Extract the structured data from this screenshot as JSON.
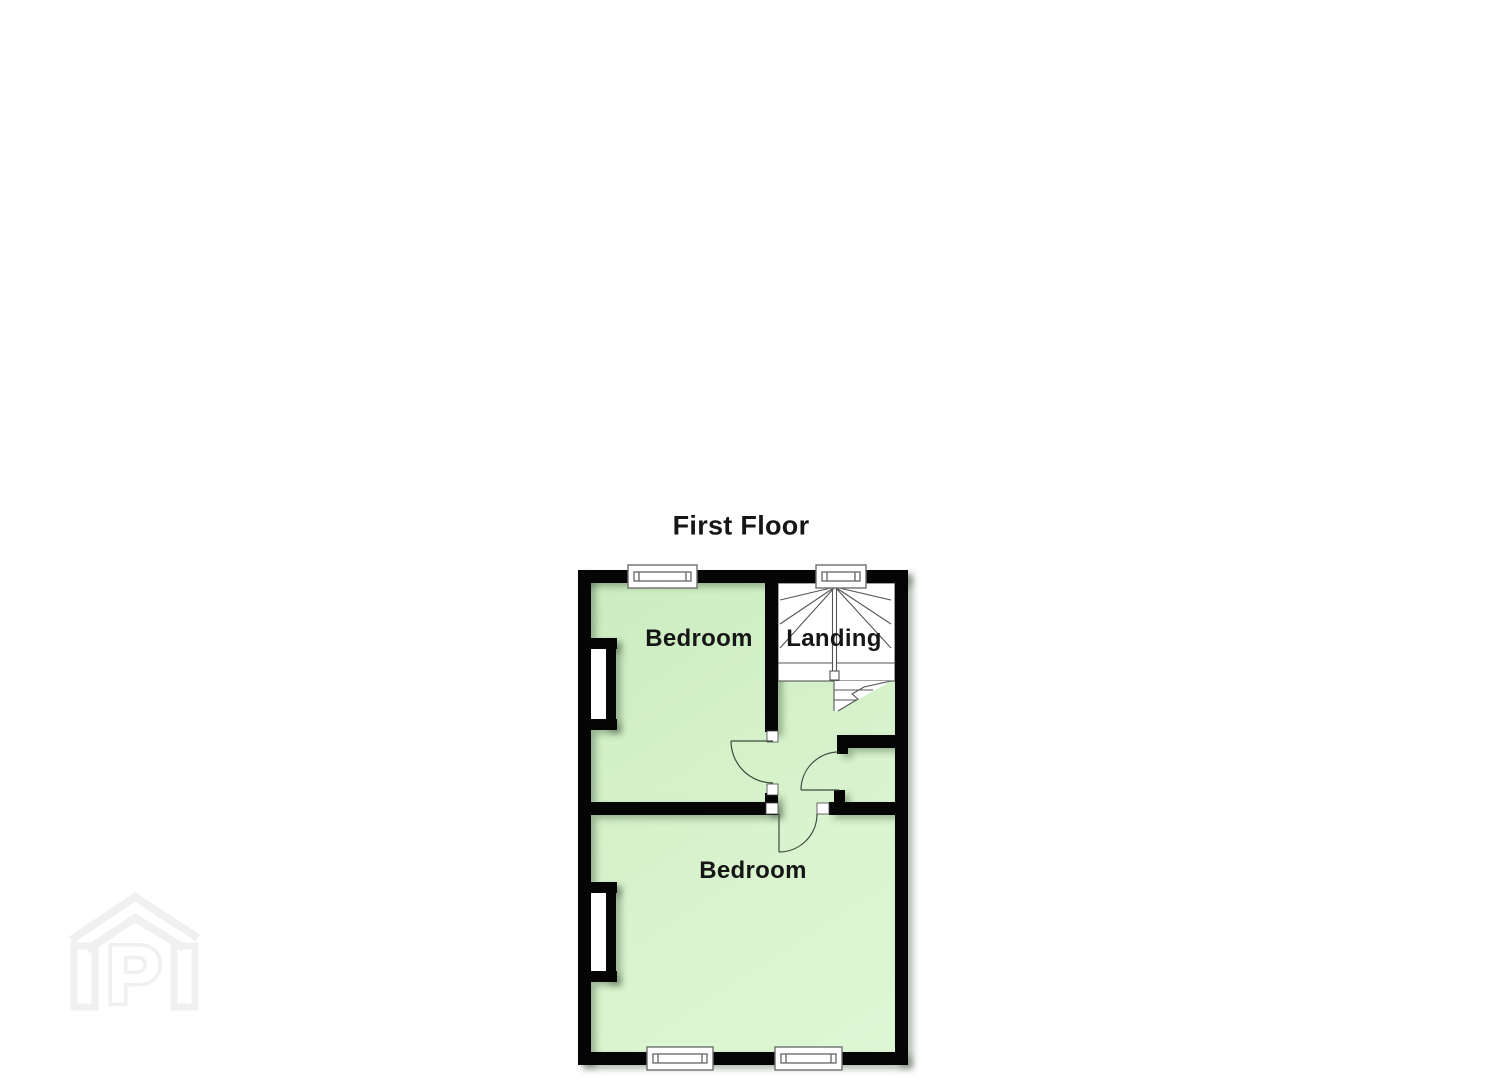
{
  "floorplan": {
    "title": "First Floor",
    "rooms": [
      {
        "id": "bedroom-1",
        "label": "Bedroom"
      },
      {
        "id": "landing",
        "label": "Landing"
      },
      {
        "id": "bedroom-2",
        "label": "Bedroom"
      }
    ],
    "features": {
      "staircase": "winder staircase in landing",
      "door_count": 3,
      "window_count": 4,
      "wall_recess_count": 2
    },
    "colors": {
      "wall": "#050505",
      "floor_fill": "#d6f2ca",
      "floor_fill_light": "#def7d4",
      "stair_line": "#555555",
      "window_frame": "#6e6e6e",
      "door_swing": "#3c4a3c"
    }
  },
  "watermark": {
    "letter": "P",
    "color": "#f0f0f0"
  }
}
